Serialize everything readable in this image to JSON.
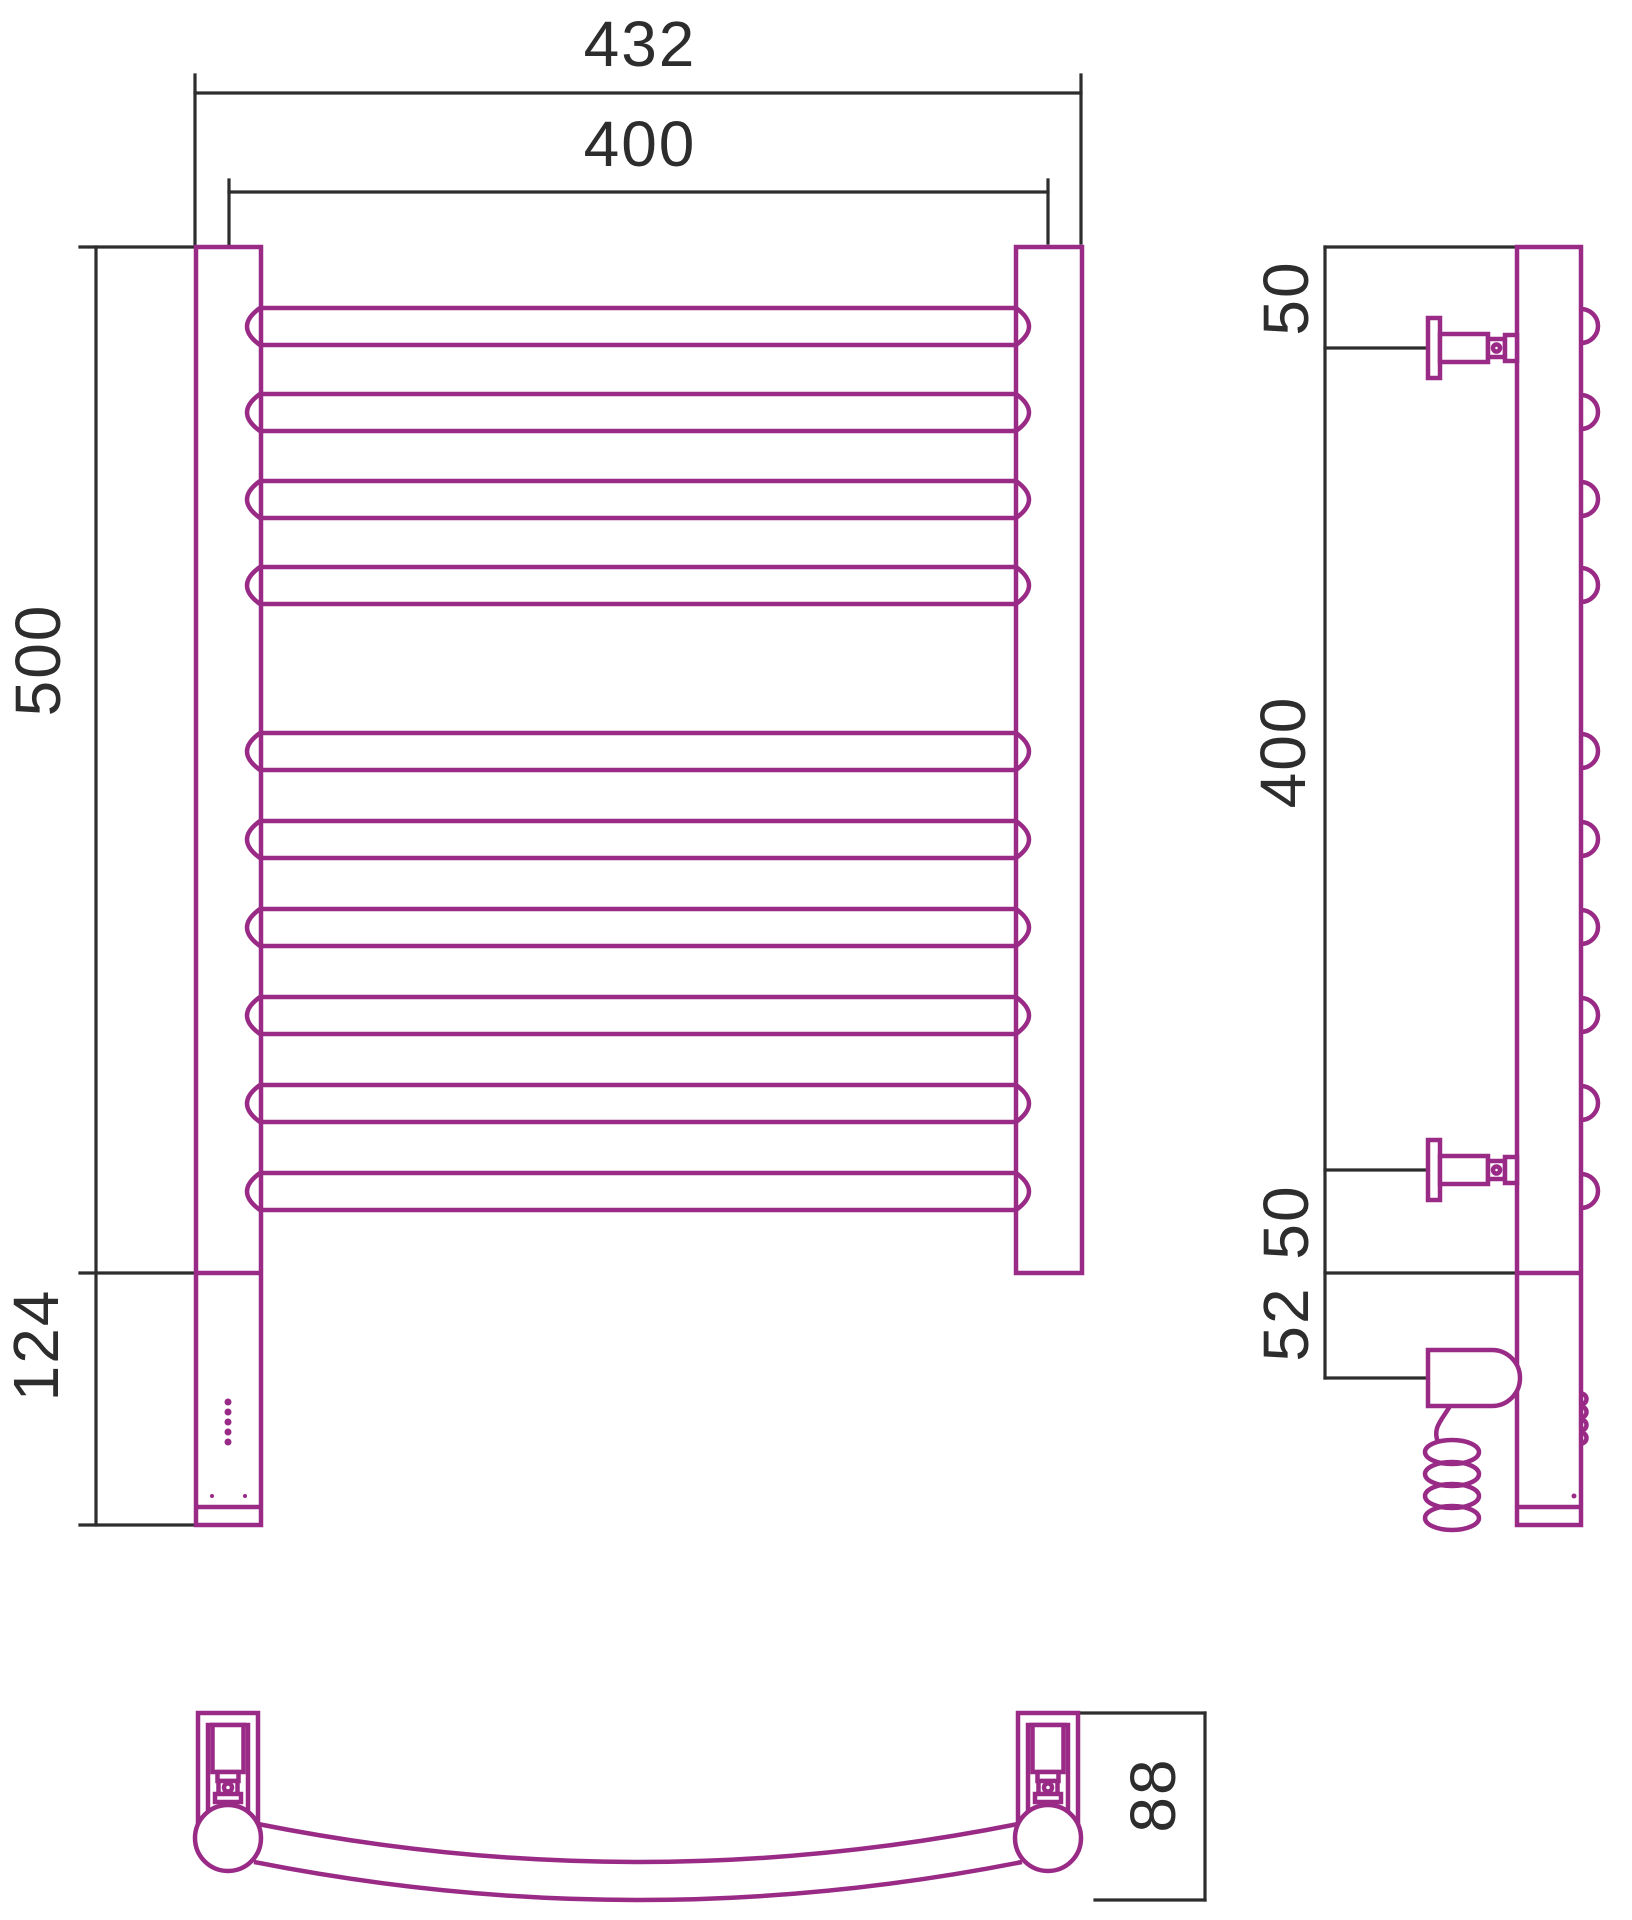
{
  "drawing": {
    "background": "#ffffff",
    "product_color": "#992b87",
    "dimension_color": "#2d2d2d",
    "product_stroke": 4.5,
    "dimension_stroke": 3.2,
    "dimension_labels": [
      {
        "id": "overall-width",
        "value": "432",
        "transform": "translate(640 66)"
      },
      {
        "id": "rung-span",
        "value": "400",
        "transform": "translate(640 166)"
      },
      {
        "id": "height-centers",
        "value": "500",
        "transform": "translate(60 660) rotate(-90)"
      },
      {
        "id": "control-box-height",
        "value": "124",
        "transform": "translate(58 1345) rotate(-90)"
      },
      {
        "id": "side-top-offset",
        "value": "50",
        "transform": "translate(1308 298) rotate(-90)"
      },
      {
        "id": "side-rung-span",
        "value": "400",
        "transform": "translate(1305 752) rotate(-90)"
      },
      {
        "id": "side-bottom-offset",
        "value": "50",
        "transform": "translate(1308 1222) rotate(-90)"
      },
      {
        "id": "side-heater-offset",
        "value": "52",
        "transform": "translate(1308 1324) rotate(-90)"
      },
      {
        "id": "depth",
        "value": "88",
        "transform": "translate(1175 1795) rotate(-90)"
      }
    ],
    "dimension_segments": [
      {
        "name": "front-432-ext-left",
        "x1": 195,
        "y1": 75,
        "x2": 195,
        "y2": 245
      },
      {
        "name": "front-432-ext-right",
        "x1": 1081,
        "y1": 75,
        "x2": 1081,
        "y2": 243
      },
      {
        "name": "front-432-dim-line",
        "x1": 195,
        "y1": 93,
        "x2": 1081,
        "y2": 93
      },
      {
        "name": "front-400-ext-left",
        "x1": 229,
        "y1": 180,
        "x2": 229,
        "y2": 245
      },
      {
        "name": "front-400-ext-right",
        "x1": 1048,
        "y1": 180,
        "x2": 1048,
        "y2": 243
      },
      {
        "name": "front-400-dim-line",
        "x1": 229,
        "y1": 192,
        "x2": 1048,
        "y2": 192
      },
      {
        "name": "front-500-tick-top",
        "x1": 80,
        "y1": 247,
        "x2": 196,
        "y2": 247
      },
      {
        "name": "front-height-dim-line",
        "x1": 96,
        "y1": 247,
        "x2": 96,
        "y2": 1525
      },
      {
        "name": "front-500-tick-bottom",
        "x1": 80,
        "y1": 1273,
        "x2": 196,
        "y2": 1273
      },
      {
        "name": "front-124-tick-bottom",
        "x1": 80,
        "y1": 1525,
        "x2": 196,
        "y2": 1525
      },
      {
        "name": "side-tick-post-top",
        "x1": 1325,
        "y1": 247,
        "x2": 1517,
        "y2": 247
      },
      {
        "name": "side-height-dim-line",
        "x1": 1325,
        "y1": 247,
        "x2": 1325,
        "y2": 1378
      },
      {
        "name": "side-tick-valve-top",
        "x1": 1325,
        "y1": 348,
        "x2": 1429,
        "y2": 348
      },
      {
        "name": "side-tick-valve-bottom",
        "x1": 1325,
        "y1": 1170,
        "x2": 1429,
        "y2": 1170
      },
      {
        "name": "side-tick-ladder-bottom",
        "x1": 1325,
        "y1": 1273,
        "x2": 1518,
        "y2": 1273
      },
      {
        "name": "side-tick-heater",
        "x1": 1325,
        "y1": 1378,
        "x2": 1429,
        "y2": 1378
      },
      {
        "name": "bottom-88-dim-line",
        "x1": 1205,
        "y1": 1713,
        "x2": 1205,
        "y2": 1900
      },
      {
        "name": "bottom-88-tick-top",
        "x1": 1078,
        "y1": 1713,
        "x2": 1205,
        "y2": 1713
      },
      {
        "name": "bottom-88-tick-bottom",
        "x1": 1095,
        "y1": 1900,
        "x2": 1205,
        "y2": 1900
      }
    ],
    "front_view": {
      "posts": [
        {
          "name": "front-left-post",
          "x": 196,
          "y": 247,
          "w": 65,
          "h": 1278
        },
        {
          "name": "front-right-post",
          "x": 1016,
          "y": 247,
          "w": 66,
          "h": 1026
        }
      ],
      "panel_lines": [
        {
          "name": "control-box-top-edge",
          "x1": 196,
          "y1": 1273,
          "x2": 261,
          "y2": 1273
        },
        {
          "name": "control-box-cap-edge",
          "x1": 196,
          "y1": 1507,
          "x2": 261,
          "y2": 1507
        }
      ],
      "rungs": {
        "x1": 260,
        "x2": 1016,
        "height": 37,
        "arc": 26,
        "tops": [
          308,
          394,
          481,
          567,
          733,
          821,
          909,
          997,
          1085,
          1173
        ]
      },
      "led_dots": {
        "cx": 228,
        "r": 3.5,
        "cys": [
          1402,
          1412,
          1422,
          1432,
          1442
        ]
      },
      "screw_dots": {
        "r": 2,
        "points": [
          [
            212,
            1496
          ],
          [
            245,
            1496
          ]
        ]
      }
    },
    "side_view": {
      "post": {
        "x": 1517,
        "y": 247,
        "w": 64,
        "h": 1278
      },
      "panel_lines": [
        {
          "name": "side-ladder-bottom-edge",
          "x1": 1517,
          "y1": 1273,
          "x2": 1581,
          "y2": 1273
        },
        {
          "name": "side-cap-edge",
          "x1": 1517,
          "y1": 1507,
          "x2": 1581,
          "y2": 1507
        }
      ],
      "rung_bumps": {
        "x": 1581,
        "r": 17,
        "centers": [
          326,
          412,
          499,
          585,
          751,
          839,
          927,
          1015,
          1103,
          1191
        ]
      },
      "valves": {
        "centers": [
          348,
          1170
        ],
        "flange": {
          "x": 1428,
          "w": 12,
          "half_h": 30
        },
        "body": {
          "x": 1440,
          "w": 48,
          "half_h": 14
        },
        "nut": {
          "x": 1488,
          "w": 17,
          "half_h": 9,
          "circle_r": 3.5
        },
        "cap": {
          "x": 1505,
          "w": 12,
          "half_h": 13
        }
      },
      "heater": {
        "path": "M 1428 1350 H 1492 A 28 28 0 0 1 1492 1406 H 1428 Z"
      },
      "coil": {
        "lead": "M 1450 1406 C 1442 1420 1432 1428 1438 1442",
        "cx": 1452,
        "rx": 27,
        "ry": 12,
        "cys": [
          1452,
          1474,
          1496,
          1518
        ]
      },
      "edge_bumps": {
        "x": 1581,
        "r": 5.5,
        "centers": [
          1399,
          1412,
          1425,
          1438
        ]
      },
      "dot": {
        "cx": 1574,
        "cy": 1496,
        "r": 2.5
      }
    },
    "bottom_view": {
      "tube_paths": [
        "M 258 1824 Q 638 1900 1018 1824",
        "M 254 1862 Q 638 1938 1022 1862"
      ],
      "mount_cx": [
        228,
        1048
      ],
      "mount": {
        "outer_top": 1713,
        "inner_top": 1725,
        "leg_bottom": 1830,
        "outer_half": 30,
        "inner_half": 20,
        "piston": {
          "half_w": 15.5,
          "y": 1725,
          "h": 47
        },
        "stem": {
          "half_w": 10.5,
          "y": 1772,
          "h": 9
        },
        "nut": {
          "half_w": 9.5,
          "y": 1781,
          "h": 13,
          "circle_cy": 1787.5,
          "circle_r": 4
        },
        "collar": {
          "half_w": 13,
          "y": 1794,
          "h": 8
        },
        "circle": {
          "cy": 1838,
          "r": 33
        }
      }
    }
  }
}
